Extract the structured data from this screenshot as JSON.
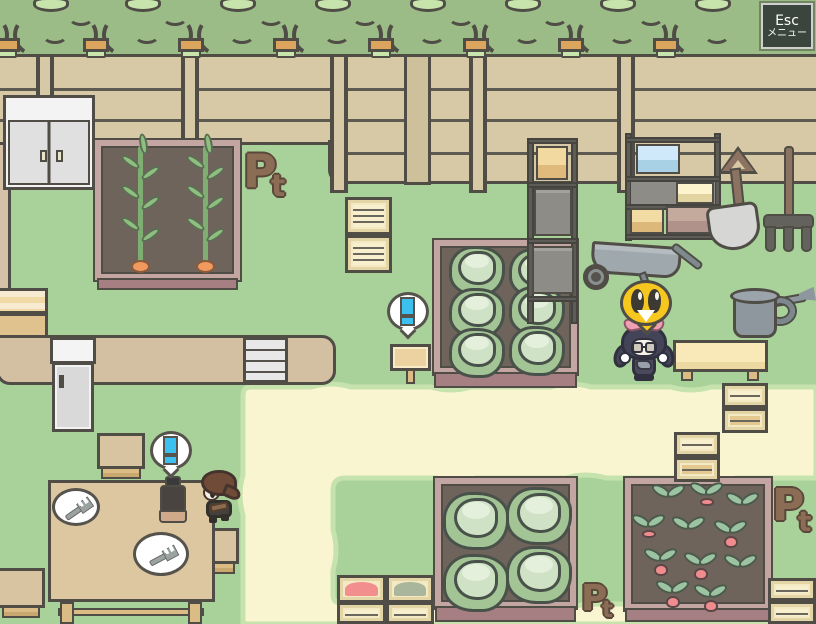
{
  "hud": {
    "esc_button": {
      "label": "Esc",
      "sublabel": "メニュー"
    }
  },
  "decorations": {
    "pt_marker": {
      "big": "P",
      "small": "t"
    },
    "pt_marker_count": 3
  },
  "bubbles": {
    "alert": {
      "symbol": "!",
      "symbol_color": "#3bc0ef",
      "count": 2
    },
    "emote": {
      "type": "surprised-bird-face",
      "color": "#f6c71e"
    }
  },
  "characters": [
    {
      "name": "villager-brown-hair",
      "location": "near-dining-table"
    },
    {
      "name": "maid-catgirl-pink-bows",
      "location": "near-work-bench"
    }
  ],
  "palette": {
    "grass": "#a9d19a",
    "path": "#f9f5d0",
    "path_edge": "#c6e2ad",
    "hedge": "#9bbc87",
    "fence": "#d7c9a5",
    "outline": "#4f4d46",
    "soil": "#6f645b",
    "bed_frame": "#c3a6a1",
    "bed_footer": "#a57f82",
    "accent_cyan": "#3bc0ef",
    "emote_yellow": "#f6c71e",
    "pt_brown": "#8b6c55"
  },
  "scene": {
    "objects": [
      "hedge-row",
      "wooden-fence",
      "white-cabinet",
      "carrot-bed",
      "cabbage-bed-six",
      "cabbage-bed-four",
      "radish-bed",
      "tall-storage-shelf",
      "wide-storage-shelf",
      "wheelbarrow",
      "watering-can",
      "shovel",
      "pitchfork",
      "work-bench",
      "wooden-sign",
      "dining-table",
      "plates-with-forks",
      "thermos-bottle",
      "stools",
      "fridge",
      "drawer-unit",
      "slat-crates",
      "produce-crates",
      "sand-path",
      "point-markers"
    ],
    "crops": {
      "carrots": 2,
      "cabbages_large_bed": 6,
      "cabbages_small_bed": 4,
      "radishes": 11
    }
  }
}
